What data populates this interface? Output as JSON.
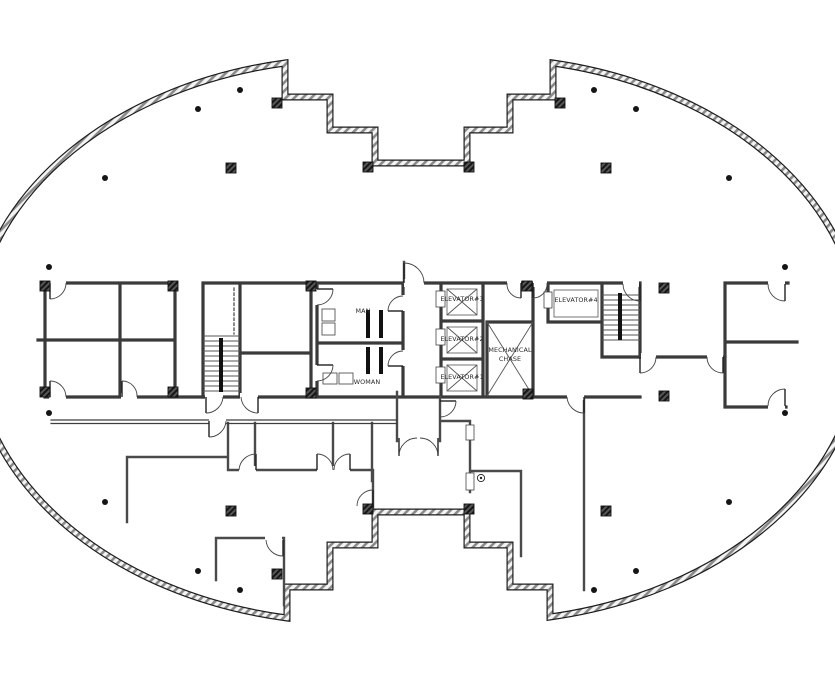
{
  "drawing": {
    "type": "architectural-floor-plan",
    "labels": {
      "man": "MAN",
      "woman": "WOMAN",
      "elevator1": "ELEVATOR#1",
      "elevator2": "ELEVATOR#2",
      "elevator3": "ELEVATOR#3",
      "elevator4": "ELEVATOR#4",
      "mechanical1": "MECHANICAL",
      "mechanical2": "CHASE"
    },
    "symbols": {
      "columns": "hatched-square-column",
      "perimeter_markers": "round-column-dot",
      "floor_drain": "circle-marker",
      "doors": "quarter-arc-swing"
    },
    "colors": {
      "line": "#3a3a3a",
      "shell_hatch": "#8a8a8a",
      "column_fill": "#2f2f2f",
      "background": "#ffffff"
    }
  }
}
